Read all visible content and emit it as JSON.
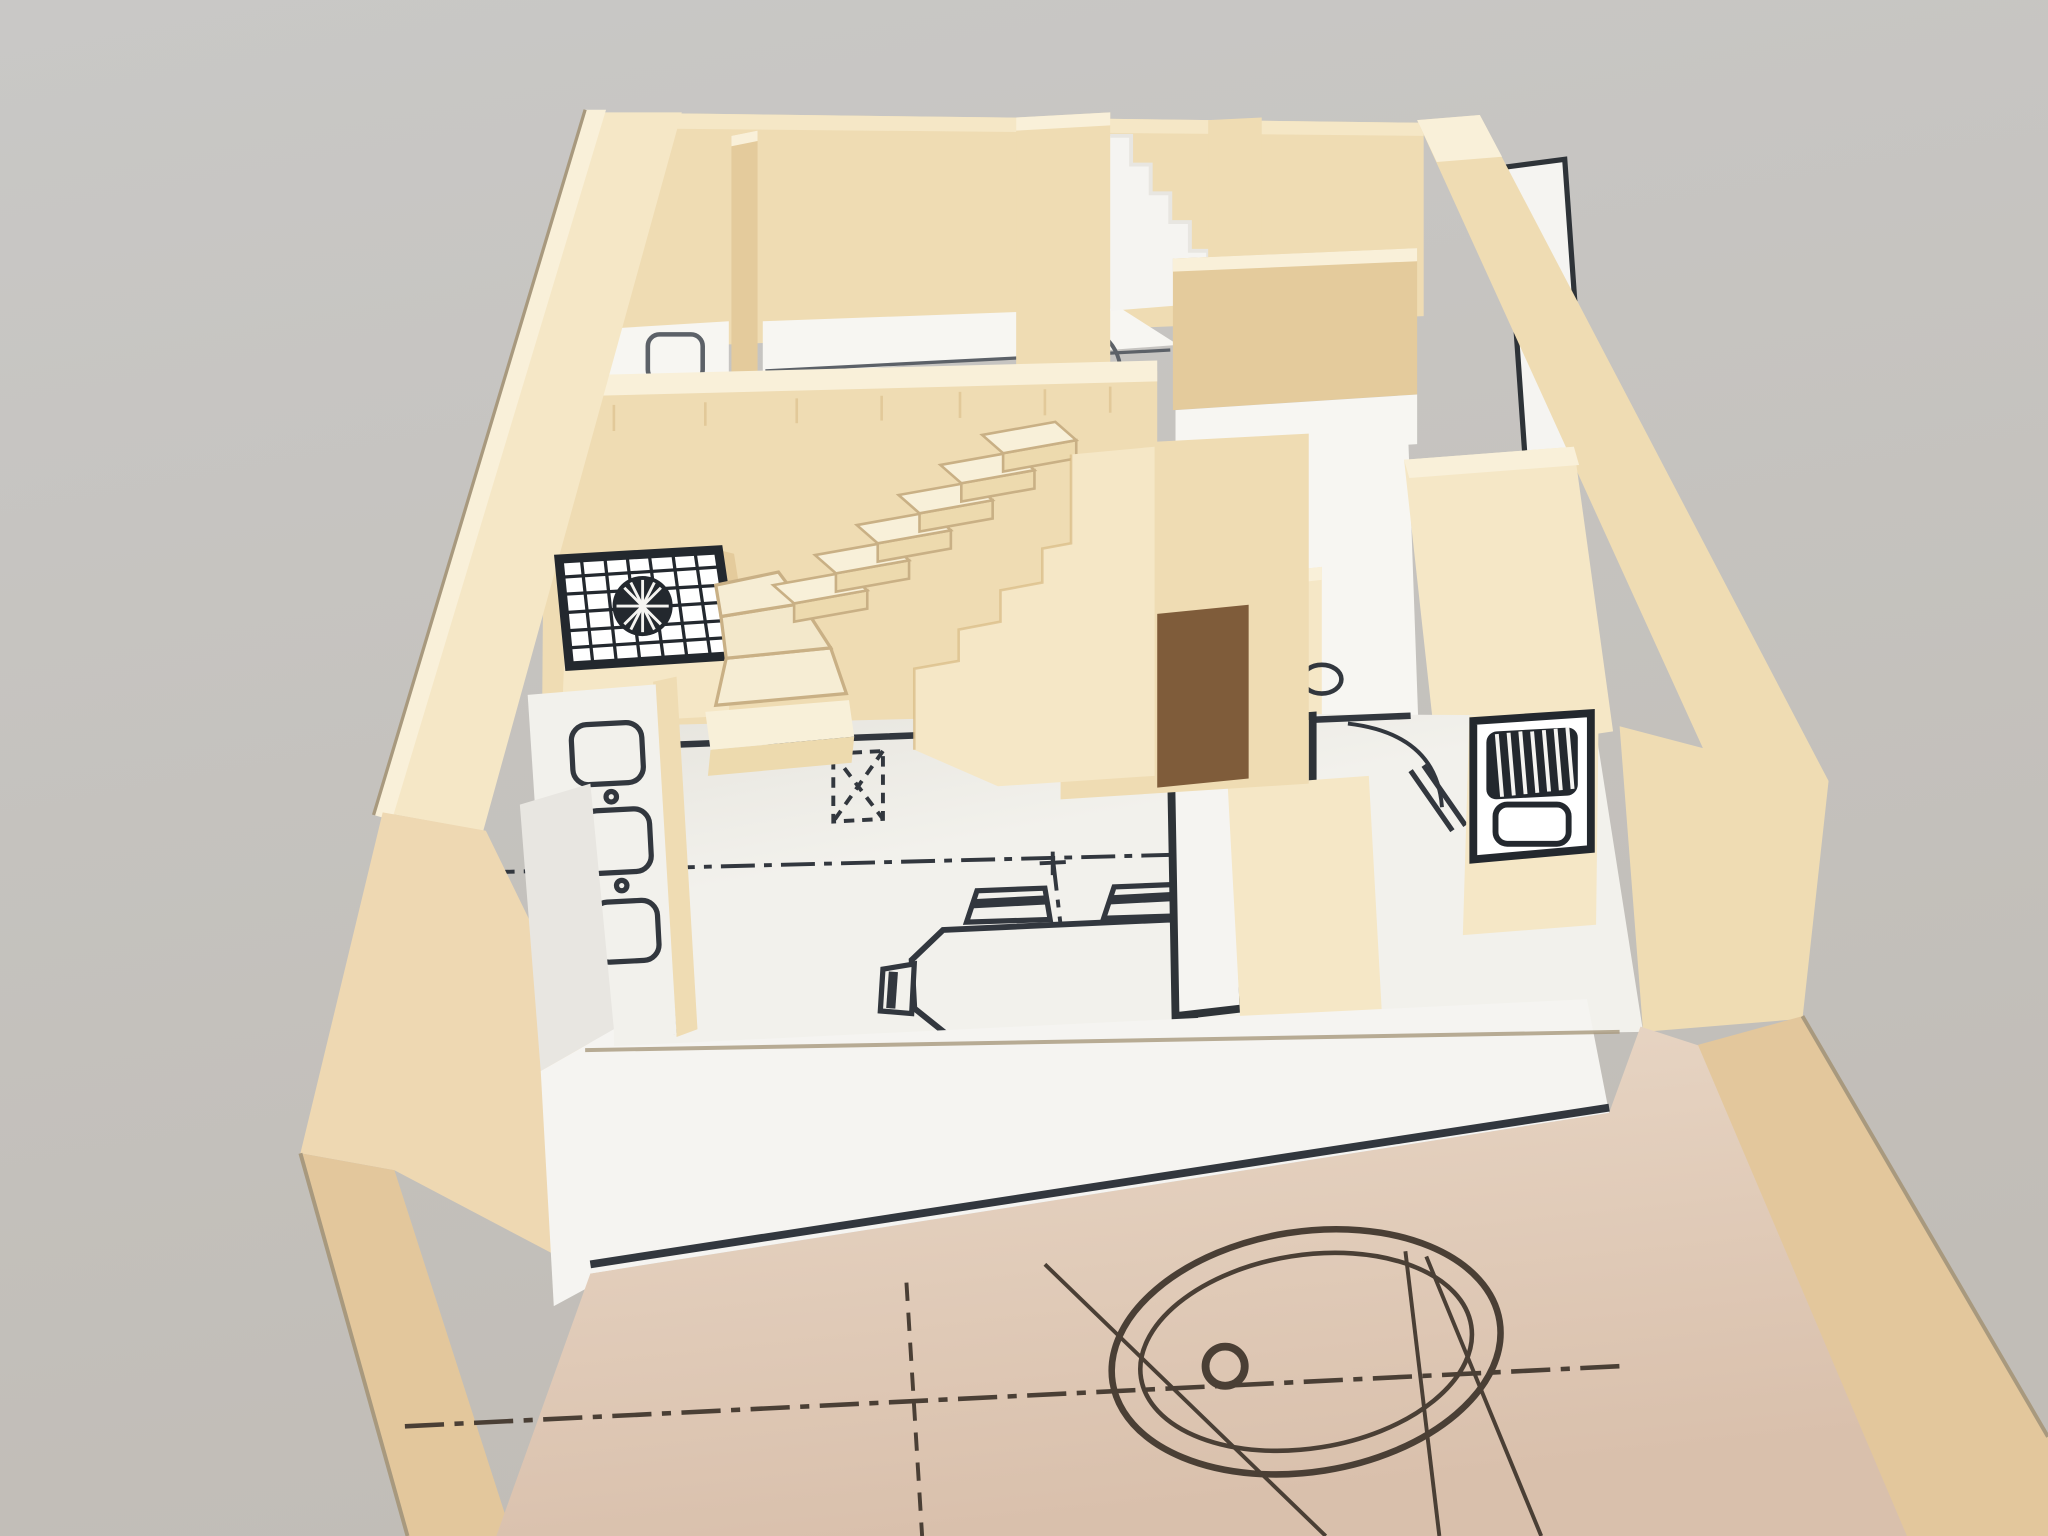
{
  "image_type": "photograph",
  "scene": {
    "parts": [
      "gray-backdrop",
      "plinth-box",
      "lower-floor-plan",
      "turning-circle-symbol",
      "front-parapet-wall",
      "left-exterior-wall",
      "right-exterior-wall",
      "rear-rooms",
      "toilet-symbol",
      "door-swing-arc",
      "zigzag-stair-profile",
      "open-door-leaf",
      "stair-back-wall",
      "winder-staircase",
      "stair-stringer-wall",
      "under-stair-doorway",
      "shower-tray",
      "floor-drain-rosette",
      "kitchen-counter-left",
      "sink-symbols",
      "kitchen-island",
      "island-counter-top",
      "kitchen-sink-unit",
      "drainer-hatch",
      "main-floor",
      "dining-table-symbol",
      "chair-symbols",
      "column-symbol",
      "centerlines"
    ]
  },
  "colors": {
    "bg_top": "#c9c8c6",
    "bg_bottom": "#c1bdb7",
    "wall_top": "#f9f0d9",
    "wall_lit": "#f5e7c6",
    "wall_mid": "#efdcb3",
    "wall_shade": "#e4cb9c",
    "wall_deep": "#d8ba84",
    "box_face": "#eed8b2",
    "box_face_shade": "#e3c79c",
    "doorway_dark": "#7f5c3a",
    "white_wall": "#f5f4f1",
    "white_wall_shade": "#e8e6e1",
    "floor_white": "#f2f1ec",
    "floor_back": "#f7f6f2",
    "floor_shade": "#e6e4dd",
    "lower_floor": "#ead9c8",
    "lower_floor_shade": "#d9c0ac",
    "step_top": "#f8f0d9",
    "step_front": "#eddaae",
    "seam": "#c9b085",
    "plan_line": "#32373e",
    "plan_soft": "#5c6168",
    "lower_line": "#4a3f35",
    "grid_dark": "#23282e",
    "edge_dark": "#a8997e"
  }
}
